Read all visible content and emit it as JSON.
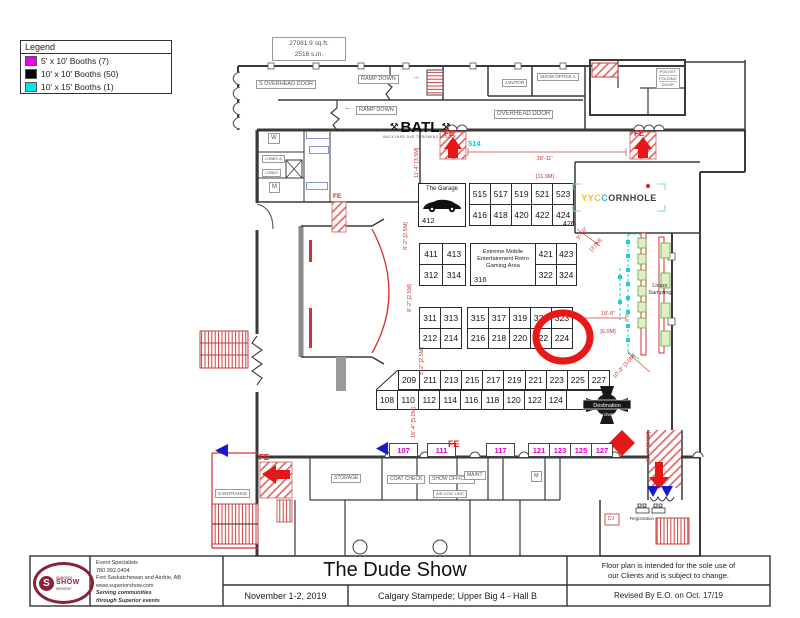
{
  "legend": {
    "title": "Legend",
    "items": [
      {
        "color": "#ee00ee",
        "label": "5' x 10' Booths (7)"
      },
      {
        "color": "#000000",
        "label": "10' x 10' Booths (50)"
      },
      {
        "color": "#00e5e5",
        "label": "10' x 15' Booths (1)"
      }
    ]
  },
  "area_info": {
    "line1": "27081.9 sq.ft.",
    "line2": "2516 s.m."
  },
  "top_labels": {
    "s_overhead_door": "S OVERHEAD DOOR",
    "ramp_down_1": "RAMP DOWN",
    "ramp_down_2": "RAMP DOWN",
    "overhead_door": "OVERHEAD DOOR",
    "janitor": "JANITOR",
    "show_office_a": "SHOW OFFICE A",
    "pocket1": "POCKET",
    "pocket2": "FOLDING",
    "pocket3": "DOOR"
  },
  "rooms": {
    "storage": "STORAGE",
    "coat_check": "COAT CHECK",
    "show_office_b": "SHOW OFFICE B",
    "maint": "MAINT",
    "air_con": "AIR CON. UNIT",
    "m1": "M",
    "m2": "M",
    "w": "W",
    "lobby_a": "LOBBY A",
    "lobby": "LOBBY",
    "s_entrance": "S ENTRANCE",
    "registration": "Registration",
    "dj": "DJ",
    "liquor1": "Liquor",
    "liquor2": "Sampling"
  },
  "markers": {
    "fe": "FE"
  },
  "logos": {
    "batl": {
      "name": "BATL",
      "tagline": "BACKYARD AXE THROWING LEAGUE"
    },
    "yyc": {
      "part1": "YYC",
      "part2": "C",
      "part3": "ORNHOLE"
    },
    "garage": {
      "name": "The Garage",
      "number": "412"
    },
    "archery": {
      "line1": "Destination",
      "line2": "Archery"
    },
    "superior": {
      "word1": "superior",
      "word2": "SHOW",
      "word3": "service!",
      "glyph": "S"
    }
  },
  "booths": {
    "cyan_booth": "514",
    "booth_426": "426",
    "row_515": [
      "515",
      "517",
      "519",
      "521",
      "523"
    ],
    "row_416": [
      "416",
      "418",
      "420",
      "422",
      "424"
    ],
    "row_411": [
      "411",
      "413"
    ],
    "row_312": [
      "312",
      "314"
    ],
    "gaming_area": {
      "l1": "Extreme Mobile",
      "l2": "Entertainment Retro",
      "l3": "Gaming Area",
      "number": "316"
    },
    "row_421": [
      "421",
      "423"
    ],
    "row_322": [
      "322",
      "324"
    ],
    "row_311": [
      "311",
      "313"
    ],
    "row_212": [
      "212",
      "214"
    ],
    "row_315": [
      "315",
      "317",
      "319",
      "321",
      "323"
    ],
    "row_216": [
      "216",
      "218",
      "220",
      "222",
      "224"
    ],
    "row_209": [
      "209",
      "211",
      "213",
      "215",
      "217",
      "219",
      "221",
      "223",
      "225",
      "227"
    ],
    "row_108": [
      "108",
      "110",
      "112",
      "114",
      "116",
      "118",
      "120",
      "122",
      "124"
    ],
    "row_magenta": [
      "107",
      "111",
      "117",
      "121",
      "123",
      "125",
      "127"
    ],
    "highlighted_booth": "224"
  },
  "dimensions": {
    "d38a": "38'-11\"",
    "d38b": "[11.9M]",
    "d11_4": "11'-4\" [3.5M]",
    "d8_2a": "8'-2\" [2.5M]",
    "d8_2b": "8'-2\" [2.5M]",
    "d8_2c": "8'-2\" [2.5M]",
    "d9_10a": "9'-10\"",
    "d9_10b": "[3.0M]",
    "d19_8a": "19'-8\"",
    "d19_8b": "[6.0M]",
    "d10_0": "10'-0\" [3.0M]",
    "d16_4": "16'-4\" [5.0M]",
    "d11_6": "11'-6\" [3.5M]"
  },
  "title_block": {
    "contact": {
      "line1": "Event Specialists",
      "line2": "780.992.0404",
      "line3": "Fort Saskatchewan and Airdrie, AB",
      "line4": "www.superiorshow.com",
      "line5": "Serving communities",
      "line6": "through Superior events"
    },
    "show_name": "The Dude Show",
    "date": "November 1-2, 2019",
    "venue": "Calgary Stampede; Upper Big 4 - Hall B",
    "disclaimer1": "Floor plan is intended for the sole use of",
    "disclaimer2": "our Clients and is subject to change.",
    "revision": "Revised By E.O. on Oct. 17/19"
  },
  "colors": {
    "magenta": "#e000d0",
    "cyan": "#00cfcf",
    "red": "#e02020",
    "maroon": "#8a2238",
    "green": "#6aa332"
  }
}
